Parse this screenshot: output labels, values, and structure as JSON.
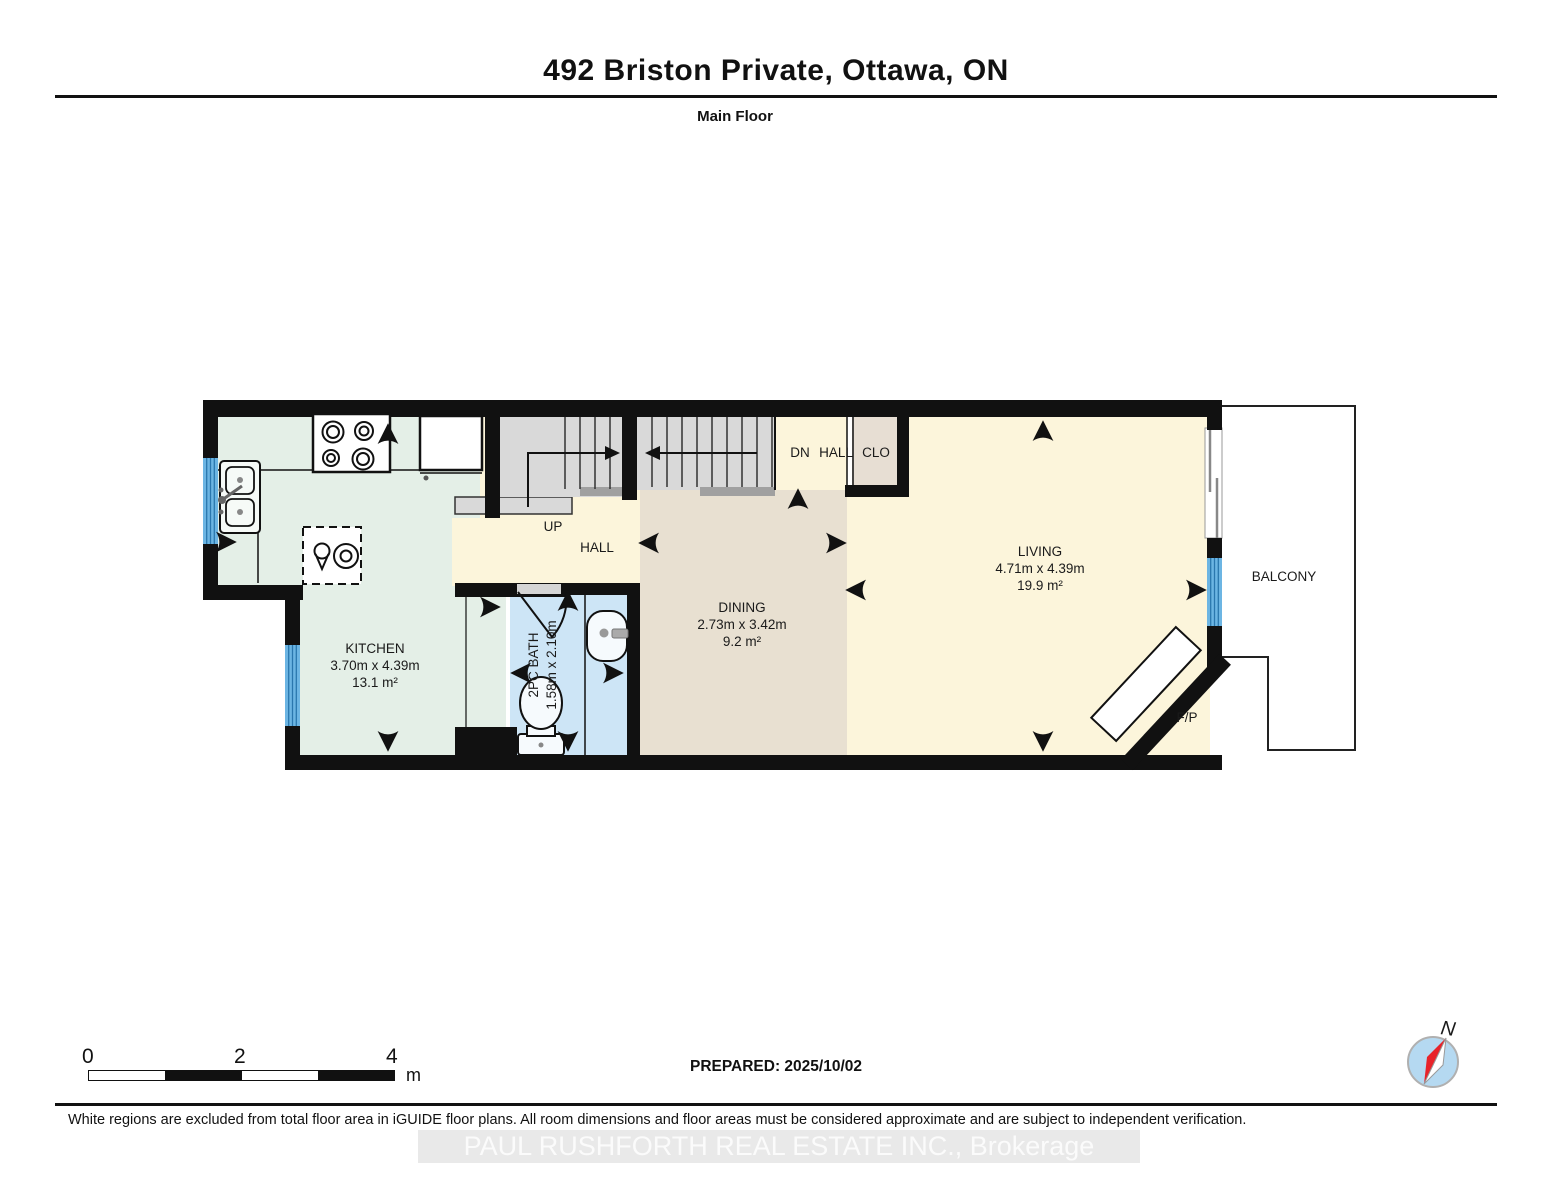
{
  "header": {
    "title": "492 Briston Private, Ottawa, ON",
    "subtitle": "Main Floor"
  },
  "plan": {
    "rooms": {
      "kitchen": {
        "name": "KITCHEN",
        "dimensions": "3.70m x 4.39m",
        "area": "13.1 m²"
      },
      "dining": {
        "name": "DINING",
        "dimensions": "2.73m x 3.42m",
        "area": "9.2 m²"
      },
      "living": {
        "name": "LIVING",
        "dimensions": "4.71m x 4.39m",
        "area": "19.9 m²"
      },
      "bath": {
        "name": "2PC BATH",
        "dimensions": "1.58m x 2.10m"
      },
      "hall": {
        "name": "HALL"
      },
      "balcony": {
        "name": "BALCONY"
      },
      "closet": {
        "name": "CLO"
      },
      "fireplace": {
        "name": "F/P"
      }
    },
    "stairs": {
      "up_label": "UP",
      "down_label": "DN",
      "down_hall_label": "HALL"
    }
  },
  "scale_bar": {
    "ticks": [
      "0",
      "2",
      "4"
    ],
    "unit": "m"
  },
  "compass": {
    "north_label": "N"
  },
  "footer": {
    "prepared": "PREPARED: 2025/10/02",
    "disclaimer": "White regions are excluded from total floor area in iGUIDE floor plans. All room dimensions and floor areas must be considered approximate and are subject to independent verification.",
    "watermark": "PAUL RUSHFORTH REAL ESTATE INC., Brokerage"
  },
  "colors": {
    "wall": "#111111",
    "kitchen_fill": "#e4efe7",
    "hall_fill": "#fcf5db",
    "dining_fill": "#e8e0d1",
    "living_fill": "#fcf5db",
    "closet_fill": "#e7ded3",
    "bath_fill": "#cde5f6",
    "stair_fill": "#d9d9d9",
    "window_blue": "#6cb5e3",
    "compass_blue": "#b5d9f1",
    "needle_red": "#e8232a"
  }
}
